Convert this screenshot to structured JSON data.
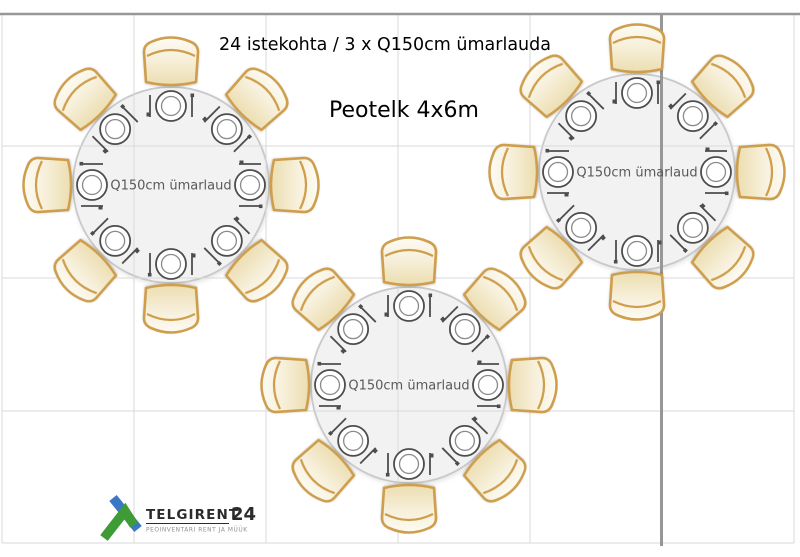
{
  "title": "24 istekohta / 3 x Q150cm ümarlauda",
  "subtitle": "Peotelk 4x6m",
  "seats_total": "24",
  "seats_per_table": 8,
  "tables": [
    {
      "id": "left",
      "label": "Q150cm ümarlaud",
      "cx": 171,
      "cy": 185
    },
    {
      "id": "right",
      "label": "Q150cm ümarlaud",
      "cx": 637,
      "cy": 172
    },
    {
      "id": "bottom",
      "label": "Q150cm ümarlaud",
      "cx": 409,
      "cy": 385
    }
  ],
  "logo": {
    "brand": "TELGIRENT",
    "number": "24",
    "tagline": "PEOINVENTARI RENT JA MÜÜK"
  },
  "colors": {
    "chair_outline": "#CE9E4C",
    "chair_fill_light": "#FEFDF8",
    "chair_fill_dark": "#EBDCAC",
    "table_fill": "#F2F2F2",
    "table_stroke": "#C9C9C9",
    "plate_stroke": "#4D4D4D",
    "plate_inner_stroke": "#8A8A8A",
    "grid_light": "#D9D9D9",
    "grid_dark": "#979797",
    "label_text": "#5A5A5A",
    "logo_blue": "#3A78C4",
    "logo_green": "#3F9B35"
  }
}
